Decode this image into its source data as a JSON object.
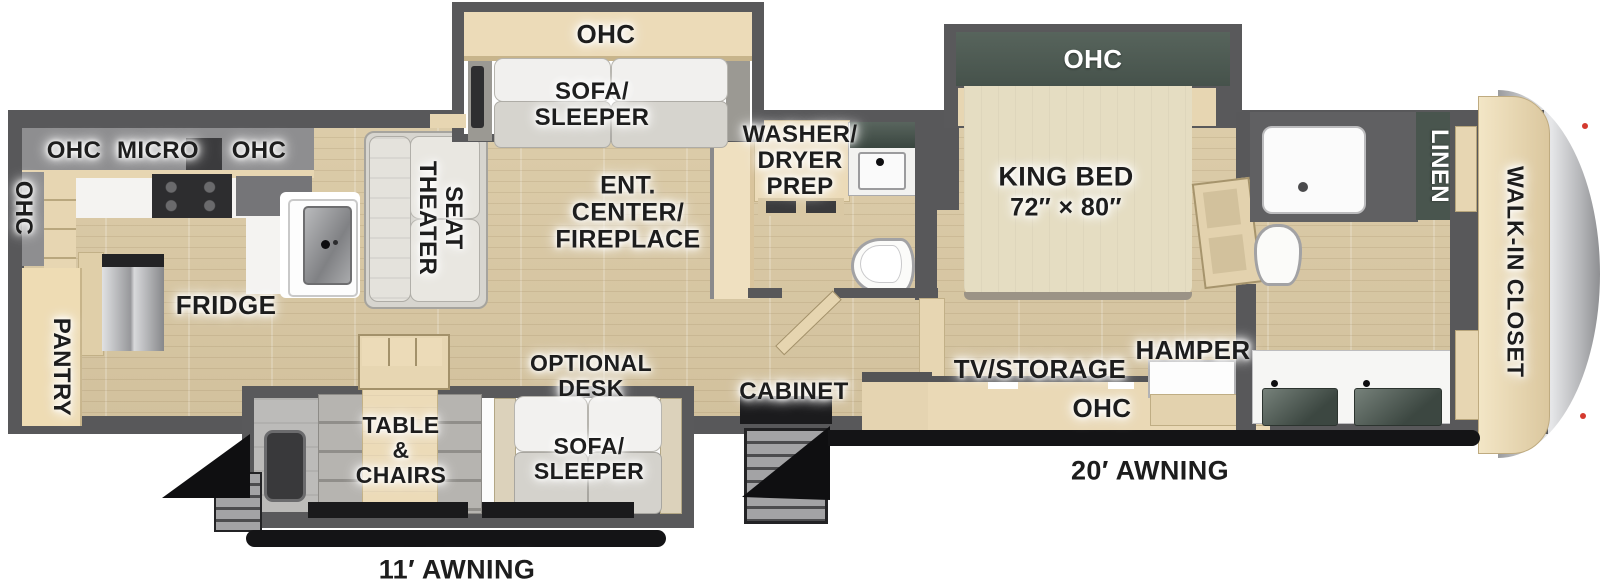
{
  "diagram": {
    "type": "rv-fifth-wheel-floorplan",
    "labels": {
      "ohc_top_slide": "OHC",
      "sofa_sleeper_top": "SOFA/\nSLEEPER",
      "ohc_kitchen_left": "OHC",
      "micro": "MICRO",
      "ohc_kitchen_right": "OHC",
      "ohc_side_wall": "OHC",
      "theater_seat": "THEATER\nSEAT",
      "ent_center_fireplace": "ENT.\nCENTER/\nFIREPLACE",
      "washer_dryer_prep": "WASHER/\nDRYER\nPREP",
      "ohc_bed_slide": "OHC",
      "king_bed": "KING BED",
      "king_bed_size": "72″ × 80″",
      "linen": "LINEN",
      "walk_in_closet": "WALK-IN CLOSET",
      "pantry": "PANTRY",
      "fridge": "FRIDGE",
      "table_chairs": "TABLE\n&\nCHAIRS",
      "optional_desk": "OPTIONAL\nDESK",
      "sofa_sleeper_bottom": "SOFA/\nSLEEPER",
      "cabinet": "CABINET",
      "tv_storage": "TV/STORAGE",
      "hamper": "HAMPER",
      "ohc_bedroom_cabinet": "OHC",
      "awning_20": "20′ AWNING",
      "awning_11": "11′ AWNING"
    },
    "colors": {
      "wall_gray": "#58585a",
      "cabinet_wood": "#e7d6b2",
      "floor_wood": "#d7c7a4",
      "accent_dark_green": "#49554e",
      "awning_black": "#141416",
      "front_cap_gray": "#c0c1c4",
      "marker_light_red": "#d43a2f"
    }
  }
}
